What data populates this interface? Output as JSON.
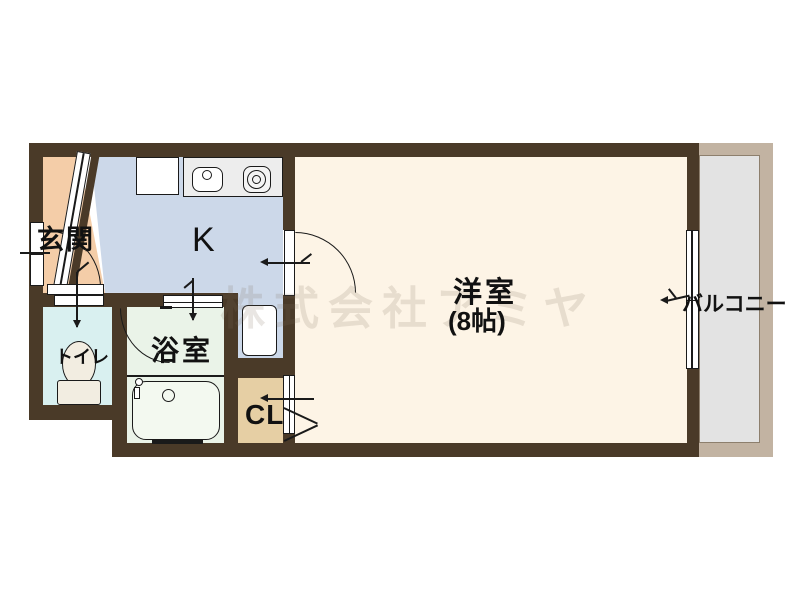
{
  "floorplan": {
    "watermark_text": "株式会社アミヤ",
    "labels": {
      "genkan": "玄関",
      "kitchen": "K",
      "toilet": "トイレ",
      "bathroom": "浴室",
      "closet": "CL",
      "western_room": "洋室",
      "western_room_size": "(8帖)",
      "balcony": "バルコニー"
    },
    "colors": {
      "wall": "#4a3a28",
      "genkan_floor": "#f4cda8",
      "kitchen_floor": "#ccd8e9",
      "toilet_floor": "#d9f0f0",
      "bathroom_floor": "#eaf3e8",
      "closet_floor": "#e6cfa4",
      "western_room_floor": "#fdf4e6",
      "balcony_floor": "#e3e3e3",
      "balcony_frame": "#c2b3a2",
      "counter": "#ededed",
      "tub_fill": "#f3f9f0",
      "ceramic": "#f2ede1"
    }
  }
}
